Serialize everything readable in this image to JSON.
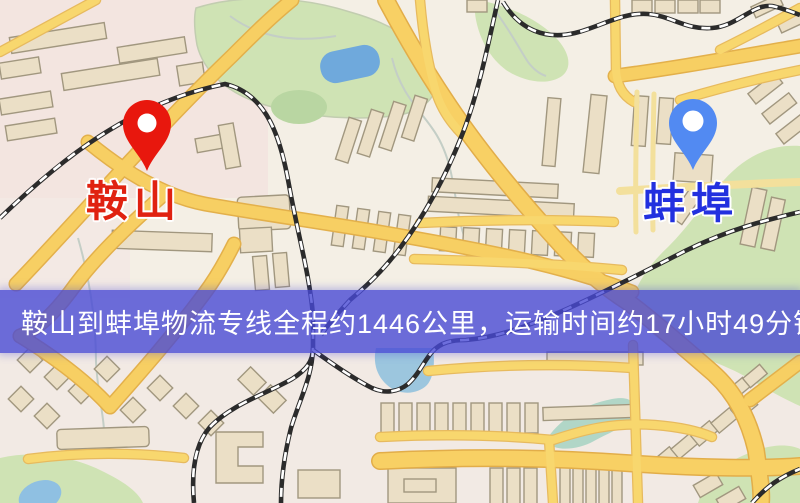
{
  "map": {
    "origin": {
      "name": "鞍山",
      "pin_color": "#e8170d",
      "label_color": "#e02211"
    },
    "destination": {
      "name": "蚌埠",
      "pin_color": "#528af2",
      "label_color": "#2230df"
    },
    "banner": {
      "text": "鞍山到蚌埠物流专线全程约1446公里，运输时间约17小时49分钟.",
      "distance_km": "1446",
      "duration_hours": "17",
      "duration_minutes": "49",
      "background_color": "#4848d4",
      "text_color": "#ffffff"
    },
    "icons": {
      "origin_pin": "map-pin-icon",
      "destination_pin": "map-pin-icon"
    },
    "palette": {
      "map_background": "#f4efe5",
      "road_major": "#f7cf63",
      "road_casing": "#e3b04b",
      "park_green": "#cfe3b4",
      "water_blue": "#6fa9dc",
      "building_fill": "#ebdfc6",
      "building_outline": "#a1977f",
      "railway_dark": "#2b2b2b"
    }
  }
}
